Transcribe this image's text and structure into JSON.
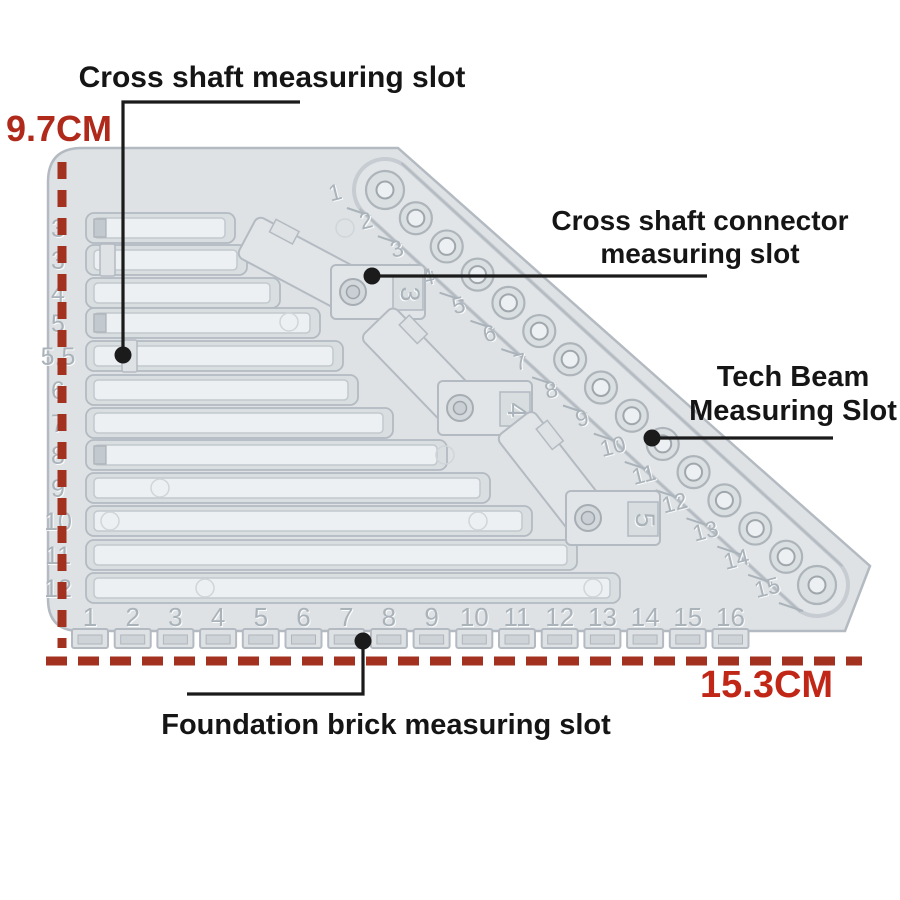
{
  "labels": {
    "cross_shaft": "Cross shaft measuring slot",
    "cross_shaft_connector": "Cross shaft connector measuring slot",
    "tech_beam": "Tech Beam Measuring Slot",
    "foundation_brick": "Foundation brick measuring slot"
  },
  "dimensions": {
    "height": "9.7CM",
    "width": "15.3CM"
  },
  "colors": {
    "background": "#ffffff",
    "dimension_text": "#b02a1b",
    "dimension_text_bright": "#c12717",
    "dimension_line": "#a33120",
    "annotation_text": "#151515",
    "leader_line": "#1b1b1b",
    "plate_fill": "#dee2e5",
    "plate_fill_light": "#e1e5e8",
    "plate_edge": "#b3bac1",
    "groove_fill": "#d9dee1",
    "slot_fill": "#edf0f2",
    "slot_edge": "#c2c9ce",
    "engraved_text": "#aab3ba",
    "hole_ring": "#adb5bb",
    "hole_inner_edge": "#9fa7ad"
  },
  "plate": {
    "left_scale": [
      "3",
      "3",
      "4",
      "5",
      "5.5",
      "6",
      "7",
      "8",
      "9",
      "10",
      "11",
      "12"
    ],
    "bottom_scale": [
      "1",
      "2",
      "3",
      "4",
      "5",
      "6",
      "7",
      "8",
      "9",
      "10",
      "11",
      "12",
      "13",
      "14",
      "15",
      "16"
    ],
    "beam_scale": [
      "1",
      "2",
      "3",
      "4",
      "5",
      "6",
      "7",
      "8",
      "9",
      "10",
      "11",
      "12",
      "13",
      "14",
      "15"
    ],
    "connector_labels": [
      "3",
      "4",
      "5"
    ],
    "slot_rows": [
      {
        "label": "3",
        "y": 228,
        "end": 225,
        "notch": "end"
      },
      {
        "label": "3",
        "y": 260,
        "end": 237,
        "notch": "tab",
        "notch_x": 100
      },
      {
        "label": "4",
        "y": 293,
        "end": 270,
        "notch": null
      },
      {
        "label": "5",
        "y": 323,
        "end": 310,
        "notch": "end"
      },
      {
        "label": "5.5",
        "y": 356,
        "end": 333,
        "notch": "tab",
        "notch_x": 122
      },
      {
        "label": "6",
        "y": 390,
        "end": 348,
        "notch": null
      },
      {
        "label": "7",
        "y": 423,
        "end": 383,
        "notch": null
      },
      {
        "label": "8",
        "y": 455,
        "end": 437,
        "notch": "end"
      },
      {
        "label": "9",
        "y": 488,
        "end": 480,
        "notch": null
      },
      {
        "label": "10",
        "y": 521,
        "end": 522,
        "notch": null
      },
      {
        "label": "11",
        "y": 555,
        "end": 567,
        "notch": null
      },
      {
        "label": "12",
        "y": 588,
        "end": 610,
        "notch": null
      }
    ],
    "geometry": {
      "outline": "M 48 182 Q 48 148 82 148 L 398 148 L 870 566 L 845 631 L 80 631 Q 48 631 48 599 Z",
      "left_scale_x": 58,
      "slot_start": 94,
      "beam": {
        "x1": 385,
        "y1": 190,
        "x2": 817,
        "y2": 585,
        "half_width": 31
      },
      "tabs": {
        "start_x": 90,
        "spacing": 42.7,
        "top": 629,
        "height": 19,
        "width": 36,
        "num_y": 626
      },
      "connectors": [
        {
          "label": "3",
          "x": 353,
          "y": 292,
          "arm": 28
        },
        {
          "label": "4",
          "x": 460,
          "y": 408,
          "arm": 46
        },
        {
          "label": "5",
          "x": 588,
          "y": 518,
          "arm": 52
        }
      ],
      "faint_circles": [
        [
          289,
          322
        ],
        [
          345,
          228
        ],
        [
          445,
          455
        ],
        [
          160,
          488
        ],
        [
          110,
          521
        ],
        [
          478,
          521
        ],
        [
          205,
          588
        ],
        [
          593,
          588
        ]
      ]
    }
  },
  "annotations": {
    "leaders": [
      {
        "name": "cross-shaft-leader",
        "points": "300,102 123,102 123,355",
        "dot": [
          123,
          355
        ]
      },
      {
        "name": "connector-leader",
        "points": "707,276 372,276",
        "dot": [
          372,
          276
        ]
      },
      {
        "name": "tech-beam-leader",
        "points": "833,438 652,438",
        "dot": [
          652,
          438
        ]
      },
      {
        "name": "foundation-leader",
        "points": "187,694 363,694 363,641",
        "dot": [
          363,
          641
        ]
      }
    ],
    "dimension_lines": {
      "height_line": {
        "x1": 62,
        "y1": 162,
        "x2": 62,
        "y2": 648,
        "dash": "17 11",
        "width": 9
      },
      "width_line": {
        "x1": 46,
        "y1": 661,
        "x2": 862,
        "y2": 661,
        "dash": "21 11",
        "width": 9
      }
    }
  }
}
